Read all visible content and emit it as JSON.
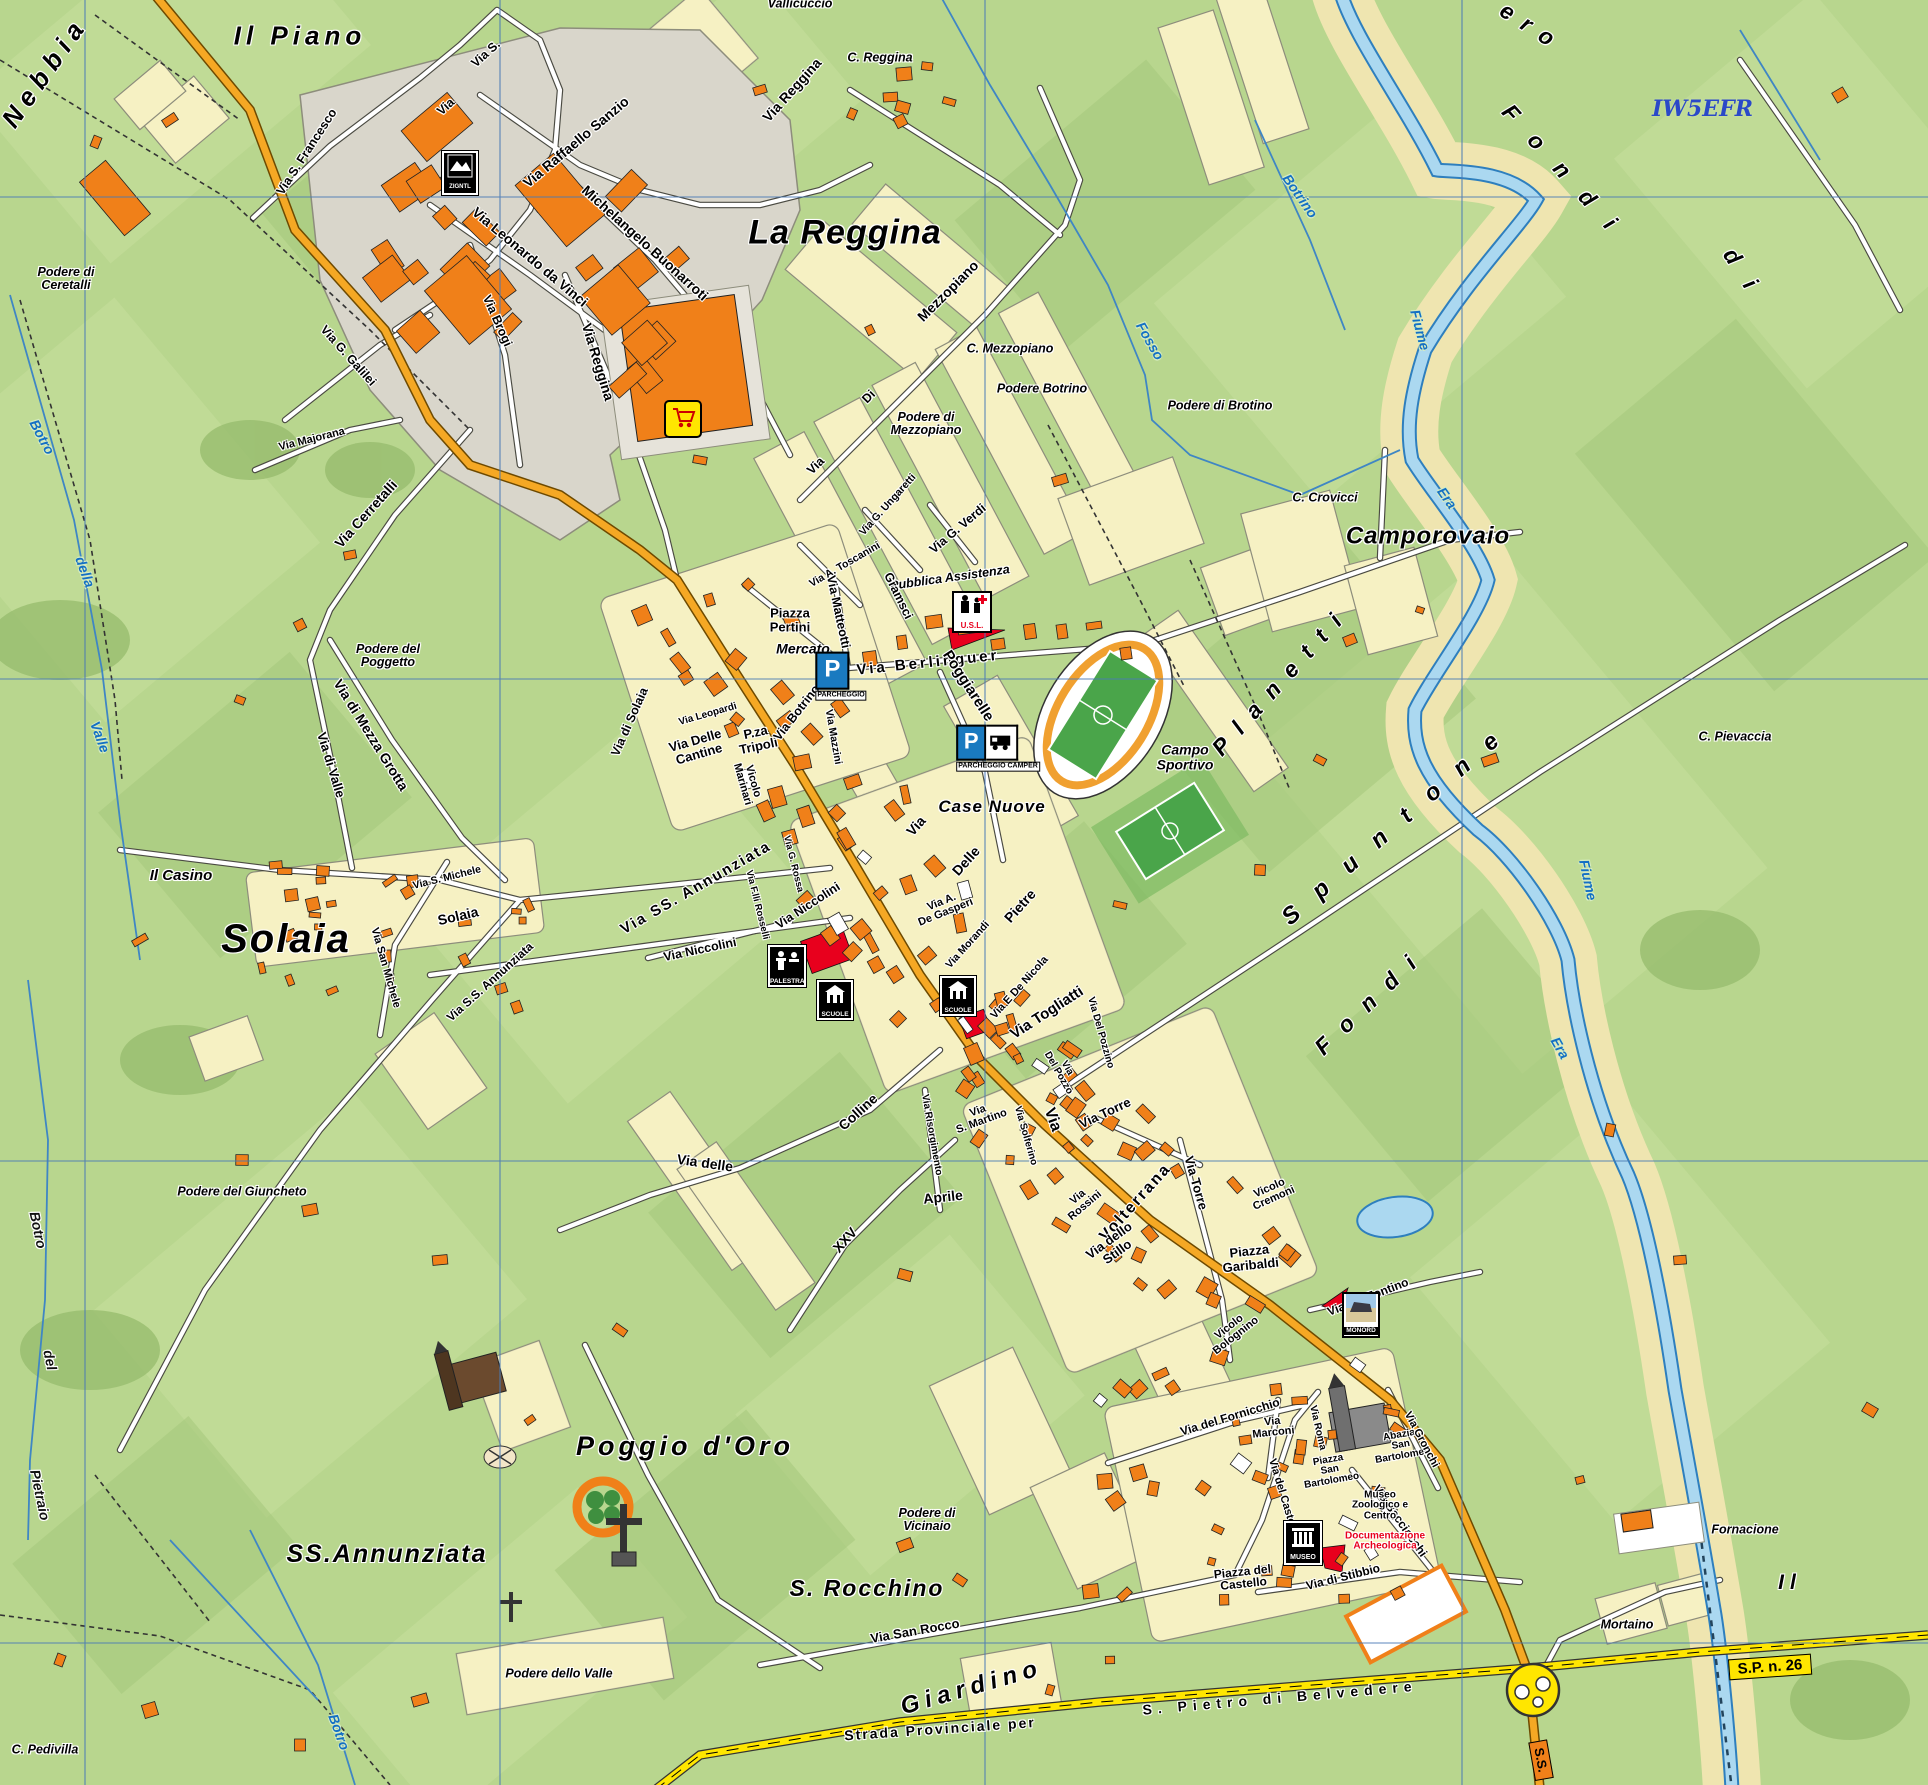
{
  "map": {
    "callsign": "IW5EFR",
    "places": [
      {
        "t": "Il Piano",
        "x": 300,
        "y": 36,
        "s": 26,
        "ls": 5
      },
      {
        "t": "Nebbia",
        "x": 45,
        "y": 72,
        "r": -55,
        "s": 26,
        "ls": 7
      },
      {
        "t": "La Reggina",
        "x": 845,
        "y": 233,
        "s": 34,
        "ls": 1
      },
      {
        "t": "Solaia",
        "x": 286,
        "y": 940,
        "s": 40,
        "ls": 2
      },
      {
        "t": "Camporovaio",
        "x": 1428,
        "y": 537,
        "s": 24,
        "ls": 1
      },
      {
        "t": "SS.Annunziata",
        "x": 387,
        "y": 1554,
        "s": 25,
        "ls": 2
      },
      {
        "t": "Poggio d'Oro",
        "x": 685,
        "y": 1446,
        "s": 27,
        "ls": 4
      },
      {
        "t": "S. Rocchino",
        "x": 867,
        "y": 1589,
        "s": 23,
        "ls": 2
      },
      {
        "t": "Giardino",
        "x": 972,
        "y": 1688,
        "r": -16,
        "s": 24,
        "ls": 6
      },
      {
        "t": "Spuntone",
        "x": 1400,
        "y": 822,
        "r": -41,
        "s": 24,
        "ls": 24
      },
      {
        "t": "Planetti",
        "x": 1282,
        "y": 680,
        "r": -48,
        "s": 23,
        "ls": 14
      },
      {
        "t": "Fondi",
        "x": 1567,
        "y": 176,
        "r": 48,
        "s": 23,
        "ls": 24
      },
      {
        "t": "Fondi",
        "x": 1372,
        "y": 1000,
        "r": -44,
        "s": 23,
        "ls": 17
      },
      {
        "t": "ero",
        "x": 1532,
        "y": 28,
        "r": 33,
        "s": 23,
        "ls": 12
      },
      {
        "t": "d i",
        "x": 1742,
        "y": 272,
        "r": 57,
        "s": 23,
        "ls": 8
      },
      {
        "t": "Il",
        "x": 1790,
        "y": 1583,
        "s": 21,
        "ls": 6
      },
      {
        "t": "Case Nuove",
        "x": 992,
        "y": 807,
        "s": 17,
        "ls": 1
      },
      {
        "t": "Il Casino",
        "x": 181,
        "y": 876,
        "s": 15
      },
      {
        "t": "Mercato",
        "x": 803,
        "y": 649,
        "s": 14
      },
      {
        "t": "Campo\nSportivo",
        "x": 1185,
        "y": 757,
        "s": 14
      }
    ],
    "localities": [
      {
        "t": "Podere di\nCeretalli",
        "x": 66,
        "y": 279
      },
      {
        "t": "Vallicuccio",
        "x": 800,
        "y": 4
      },
      {
        "t": "C. Reggina",
        "x": 880,
        "y": 58
      },
      {
        "t": "C. Mezzopiano",
        "x": 1010,
        "y": 349
      },
      {
        "t": "Podere Botrino",
        "x": 1042,
        "y": 389
      },
      {
        "t": "Podere di Brotino",
        "x": 1220,
        "y": 406
      },
      {
        "t": "Podere di\nMezzopiano",
        "x": 926,
        "y": 424
      },
      {
        "t": "C. Crovicci",
        "x": 1325,
        "y": 498
      },
      {
        "t": "Podere del\nPoggetto",
        "x": 388,
        "y": 656
      },
      {
        "t": "Podere del Giuncheto",
        "x": 242,
        "y": 1192
      },
      {
        "t": "Podere di\nVicinaio",
        "x": 927,
        "y": 1520
      },
      {
        "t": "Podere dello Valle",
        "x": 559,
        "y": 1674
      },
      {
        "t": "C. Pedivilla",
        "x": 45,
        "y": 1750
      },
      {
        "t": "C. Pievaccia",
        "x": 1735,
        "y": 737
      },
      {
        "t": "Mortaino",
        "x": 1627,
        "y": 1625
      },
      {
        "t": "Fornacione",
        "x": 1745,
        "y": 1530
      },
      {
        "t": "Pubblica Assistenza",
        "x": 950,
        "y": 578,
        "r": -8
      }
    ],
    "streets": [
      {
        "t": "Via S. Francesco",
        "x": 307,
        "y": 152,
        "r": -57
      },
      {
        "t": "Via S.",
        "x": 486,
        "y": 54,
        "r": -42
      },
      {
        "t": "Via",
        "x": 446,
        "y": 107,
        "r": -42
      },
      {
        "t": "Via Raffaello Sanzio",
        "x": 576,
        "y": 142,
        "r": -40,
        "s": 14
      },
      {
        "t": "Michelangelo Buonarroti",
        "x": 645,
        "y": 243,
        "r": 42,
        "s": 14
      },
      {
        "t": "Via Leonardo da Vinci",
        "x": 530,
        "y": 257,
        "r": 40,
        "s": 14
      },
      {
        "t": "Via Brogi",
        "x": 497,
        "y": 321,
        "r": 66
      },
      {
        "t": "Via G. Galilei",
        "x": 348,
        "y": 356,
        "r": 48
      },
      {
        "t": "Via Majorana",
        "x": 312,
        "y": 440,
        "r": -14,
        "s": 11
      },
      {
        "t": "Via Cerretalli",
        "x": 366,
        "y": 514,
        "r": -48,
        "s": 14
      },
      {
        "t": "Via   Reggina",
        "x": 792,
        "y": 90,
        "r": -48,
        "s": 14
      },
      {
        "t": "Via Reggina",
        "x": 598,
        "y": 362,
        "r": 73,
        "s": 14
      },
      {
        "t": "Via",
        "x": 816,
        "y": 466,
        "r": -45
      },
      {
        "t": "Di",
        "x": 869,
        "y": 397,
        "r": -45
      },
      {
        "t": "Mezzopiano",
        "x": 948,
        "y": 291,
        "r": -45,
        "s": 14
      },
      {
        "t": "Via G. Ungaretti",
        "x": 888,
        "y": 505,
        "r": -48,
        "s": 10.5
      },
      {
        "t": "Via G. Verdi",
        "x": 958,
        "y": 529,
        "r": -40
      },
      {
        "t": "Via A. Toscanini",
        "x": 845,
        "y": 565,
        "r": -30,
        "s": 10.5
      },
      {
        "t": "Gramsci",
        "x": 898,
        "y": 596,
        "r": 64
      },
      {
        "t": "Via Matteotti",
        "x": 838,
        "y": 612,
        "r": 78
      },
      {
        "t": "Via Berlinguer",
        "x": 928,
        "y": 663,
        "r": -6,
        "s": 15,
        "ls": 3
      },
      {
        "t": "Poggiarelle",
        "x": 968,
        "y": 686,
        "r": 57,
        "s": 15
      },
      {
        "t": "Via di Solaia",
        "x": 630,
        "y": 722,
        "r": -66
      },
      {
        "t": "Via Leopardi",
        "x": 708,
        "y": 715,
        "r": -16,
        "s": 10
      },
      {
        "t": "Via Delle\nCantine",
        "x": 697,
        "y": 747,
        "r": -16,
        "s": 13
      },
      {
        "t": "P.za\nTripoli",
        "x": 757,
        "y": 739,
        "r": -12,
        "s": 13
      },
      {
        "t": "Via Botrino",
        "x": 797,
        "y": 713,
        "r": -52
      },
      {
        "t": "Via Mazzini",
        "x": 833,
        "y": 737,
        "r": 80,
        "s": 10.5
      },
      {
        "t": "Vicolo\nMarinari",
        "x": 747,
        "y": 783,
        "r": 74,
        "s": 11
      },
      {
        "t": "Via SS.  Annunziata",
        "x": 696,
        "y": 888,
        "r": -30,
        "s": 15,
        "ls": 2
      },
      {
        "t": "Via Niccolini",
        "x": 700,
        "y": 950,
        "r": -12
      },
      {
        "t": "Via Niccolini",
        "x": 808,
        "y": 906,
        "r": -33
      },
      {
        "t": "Via F.lli Rosselli",
        "x": 757,
        "y": 905,
        "r": 76,
        "s": 9.5
      },
      {
        "t": "Via G. Rossa",
        "x": 793,
        "y": 864,
        "r": 76,
        "s": 9.5
      },
      {
        "t": "Via S. Michele",
        "x": 447,
        "y": 878,
        "r": -14,
        "s": 10.5
      },
      {
        "t": "Via San Michele",
        "x": 385,
        "y": 968,
        "r": 74,
        "s": 11
      },
      {
        "t": "Via S.S. Annunziata",
        "x": 490,
        "y": 982,
        "r": -42,
        "s": 12
      },
      {
        "t": "Solaia",
        "x": 458,
        "y": 916,
        "r": -13,
        "s": 14
      },
      {
        "t": "Via di Valle",
        "x": 331,
        "y": 765,
        "r": 73,
        "s": 13
      },
      {
        "t": "Via di Mezza Grotta",
        "x": 371,
        "y": 735,
        "r": 58,
        "s": 14
      },
      {
        "t": "Via delle",
        "x": 705,
        "y": 1163,
        "r": 8,
        "s": 14
      },
      {
        "t": "Colline",
        "x": 858,
        "y": 1112,
        "r": -42,
        "s": 14
      },
      {
        "t": "XXV",
        "x": 845,
        "y": 1240,
        "r": -48,
        "s": 14
      },
      {
        "t": "Aprile",
        "x": 943,
        "y": 1197,
        "r": -6,
        "s": 14
      },
      {
        "t": "Via A.\nDe Gasperi",
        "x": 944,
        "y": 908,
        "r": -22,
        "s": 11
      },
      {
        "t": "Via Morandi",
        "x": 968,
        "y": 945,
        "r": -48,
        "s": 10.5
      },
      {
        "t": "Via",
        "x": 916,
        "y": 826,
        "r": -48,
        "s": 14
      },
      {
        "t": "Delle",
        "x": 966,
        "y": 861,
        "r": -48,
        "s": 14
      },
      {
        "t": "Pietre",
        "x": 1020,
        "y": 906,
        "r": -48,
        "s": 14
      },
      {
        "t": "Via E De Nicola",
        "x": 1020,
        "y": 988,
        "r": -48,
        "s": 11
      },
      {
        "t": "Via Togliatti",
        "x": 1047,
        "y": 1013,
        "r": -33,
        "s": 15
      },
      {
        "t": "Via Del Pozzino",
        "x": 1100,
        "y": 1033,
        "r": 74,
        "s": 10
      },
      {
        "t": "Via\nDel Pozzo",
        "x": 1062,
        "y": 1071,
        "r": 60,
        "s": 10
      },
      {
        "t": "Via Torre",
        "x": 1105,
        "y": 1113,
        "r": -25,
        "s": 13
      },
      {
        "t": "Via  Torre",
        "x": 1196,
        "y": 1183,
        "r": 74,
        "s": 13
      },
      {
        "t": "Via Risorgimento",
        "x": 931,
        "y": 1135,
        "r": 80,
        "s": 10
      },
      {
        "t": "Via\nS. Martino",
        "x": 980,
        "y": 1117,
        "r": -20,
        "s": 11
      },
      {
        "t": "Via Solferino",
        "x": 1025,
        "y": 1136,
        "r": 74,
        "s": 10
      },
      {
        "t": "Via",
        "x": 1052,
        "y": 1120,
        "r": 70,
        "s": 16
      },
      {
        "t": "Volterrana",
        "x": 1136,
        "y": 1203,
        "r": -48,
        "s": 16,
        "ls": 2
      },
      {
        "t": "Via\nRossini",
        "x": 1082,
        "y": 1202,
        "r": -40,
        "s": 11
      },
      {
        "t": "Via dello\nStillo",
        "x": 1113,
        "y": 1246,
        "r": -36,
        "s": 13
      },
      {
        "t": "Vicolo\nCremoni",
        "x": 1272,
        "y": 1194,
        "r": -24,
        "s": 11
      },
      {
        "t": "Vicolo\nBolognino",
        "x": 1233,
        "y": 1332,
        "r": -38,
        "s": 11
      },
      {
        "t": "Via del Fontino",
        "x": 1368,
        "y": 1297,
        "r": -21,
        "s": 12
      },
      {
        "t": "Via del Fornicchio",
        "x": 1230,
        "y": 1417,
        "r": -17,
        "s": 12
      },
      {
        "t": "Via\nMarconi",
        "x": 1273,
        "y": 1428,
        "r": -6,
        "s": 11
      },
      {
        "t": "Via Roma",
        "x": 1317,
        "y": 1428,
        "r": 77,
        "s": 10
      },
      {
        "t": "Via del Castello",
        "x": 1283,
        "y": 1498,
        "r": 73,
        "s": 11
      },
      {
        "t": "Piazza\nSan\nBartolomeo",
        "x": 1330,
        "y": 1471,
        "r": -10,
        "s": 10
      },
      {
        "t": "Abazia\nSan\nBartolomeo",
        "x": 1401,
        "y": 1446,
        "r": -10,
        "s": 10
      },
      {
        "t": "Via Gronchi",
        "x": 1421,
        "y": 1440,
        "r": 62,
        "s": 11
      },
      {
        "t": "Via Bacciocchi",
        "x": 1400,
        "y": 1521,
        "r": 55,
        "s": 12
      },
      {
        "t": "Via di Stibbio",
        "x": 1343,
        "y": 1577,
        "r": -14,
        "s": 12
      },
      {
        "t": "Piazza del\nCastello",
        "x": 1243,
        "y": 1578,
        "r": -6,
        "s": 12
      },
      {
        "t": "Via San Rocco",
        "x": 915,
        "y": 1631,
        "r": -10,
        "s": 13
      },
      {
        "t": "Strada Provinciale per",
        "x": 940,
        "y": 1729,
        "r": -4,
        "s": 14,
        "ls": 2
      },
      {
        "t": "S.  Pietro  di  Belvedere",
        "x": 1280,
        "y": 1698,
        "r": -5,
        "s": 14,
        "ls": 6
      },
      {
        "t": "Piazza\nPertini",
        "x": 790,
        "y": 620,
        "s": 13
      },
      {
        "t": "Piazza\nGaribaldi",
        "x": 1250,
        "y": 1258,
        "r": -6,
        "s": 13
      },
      {
        "t": "Museo\nZoologico e\nCentro",
        "x": 1380,
        "y": 1506,
        "s": 10
      }
    ],
    "streets_red": [
      {
        "t": "Documentazione\nArcheologica",
        "x": 1385,
        "y": 1542,
        "s": 10
      }
    ],
    "water_labels": [
      {
        "t": "Botrino",
        "x": 1300,
        "y": 196,
        "r": 55
      },
      {
        "t": "Fosso",
        "x": 1150,
        "y": 341,
        "r": 60
      },
      {
        "t": "Fiume",
        "x": 1420,
        "y": 330,
        "r": 75
      },
      {
        "t": "Era",
        "x": 1447,
        "y": 498,
        "r": 55
      },
      {
        "t": "Era",
        "x": 1560,
        "y": 1048,
        "r": 60
      },
      {
        "t": "Fiume",
        "x": 1588,
        "y": 880,
        "r": 78
      },
      {
        "t": "Botro",
        "x": 42,
        "y": 437,
        "r": 62
      },
      {
        "t": "della",
        "x": 85,
        "y": 572,
        "r": 70
      },
      {
        "t": "Valle",
        "x": 100,
        "y": 737,
        "r": 70
      },
      {
        "t": "Botro",
        "x": 339,
        "y": 1732,
        "r": 70
      }
    ],
    "water_labels_dark": [
      {
        "t": "Botro",
        "x": 38,
        "y": 1230,
        "r": 78
      },
      {
        "t": "del",
        "x": 50,
        "y": 1360,
        "r": 78
      },
      {
        "t": "Pietraio",
        "x": 40,
        "y": 1495,
        "r": 78
      }
    ],
    "road_badges": [
      {
        "t": "S.P. n. 26",
        "x": 1770,
        "y": 1667,
        "r": -4,
        "kind": "sp"
      },
      {
        "t": "S.S.",
        "x": 1541,
        "y": 1760,
        "r": 80,
        "kind": "ss"
      }
    ],
    "pois": [
      {
        "type": "parking",
        "caption": "PARCHEGGIO",
        "x": 841,
        "y": 676
      },
      {
        "type": "camper",
        "caption": "PARCHEGGIO CAMPER",
        "x": 998,
        "y": 748
      },
      {
        "type": "usl",
        "caption": "U.S.L.",
        "x": 972,
        "y": 612
      },
      {
        "type": "palestra",
        "caption": "PALESTRA",
        "x": 787,
        "y": 966
      },
      {
        "type": "scuole",
        "caption": "SCUOLE",
        "x": 835,
        "y": 1000
      },
      {
        "type": "scuole",
        "caption": "SCUOLE",
        "x": 958,
        "y": 996
      },
      {
        "type": "museo",
        "caption": "MUSEO",
        "x": 1303,
        "y": 1543
      },
      {
        "type": "monord",
        "caption": "MONORD",
        "x": 1361,
        "y": 1315
      },
      {
        "type": "market",
        "caption": "",
        "x": 683,
        "y": 419
      },
      {
        "type": "industry",
        "caption": "ZIGNTL",
        "x": 460,
        "y": 173
      }
    ]
  }
}
